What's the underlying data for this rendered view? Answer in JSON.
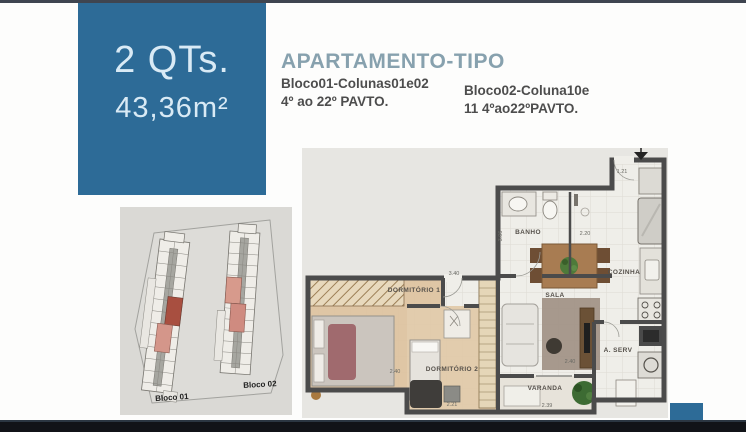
{
  "colors": {
    "accent_blue": "#2d6b97",
    "top_bar": "#3f4550",
    "bottom_bar": "#111318",
    "highlight_unit_dark": "#a84f40",
    "highlight_unit_light": "#d4968a"
  },
  "badge": {
    "title": "2 QTs.",
    "area": "43,36m²"
  },
  "header": {
    "title": "APARTAMENTO-TIPO",
    "block1": {
      "line1": "Bloco01-Colunas01e02",
      "line2": "4º ao 22º PAVTO."
    },
    "block2": {
      "line1": "Bloco02-Coluna10e",
      "line2": "11 4ºao22ºPAVTO."
    }
  },
  "site_plan": {
    "bloco1": "Bloco 01",
    "bloco2": "Bloco 02"
  },
  "floor_plan": {
    "rooms": {
      "banho": "BANHO",
      "cozinha": "COZINHA",
      "sala": "SALA",
      "dorm1": "DORMITÓRIO 1",
      "dorm2": "DORMITÓRIO 2",
      "varanda": "VARANDA",
      "aserv": "A. SERV"
    },
    "dims": {
      "entry": "1.21",
      "shower": "2.20",
      "banho_v": "3.06",
      "dorm1_top": "3.40",
      "dorm1_w": "2.40",
      "dorm2_w": "2.21",
      "varanda_w": "2.39",
      "sala_w": "2.40"
    }
  }
}
